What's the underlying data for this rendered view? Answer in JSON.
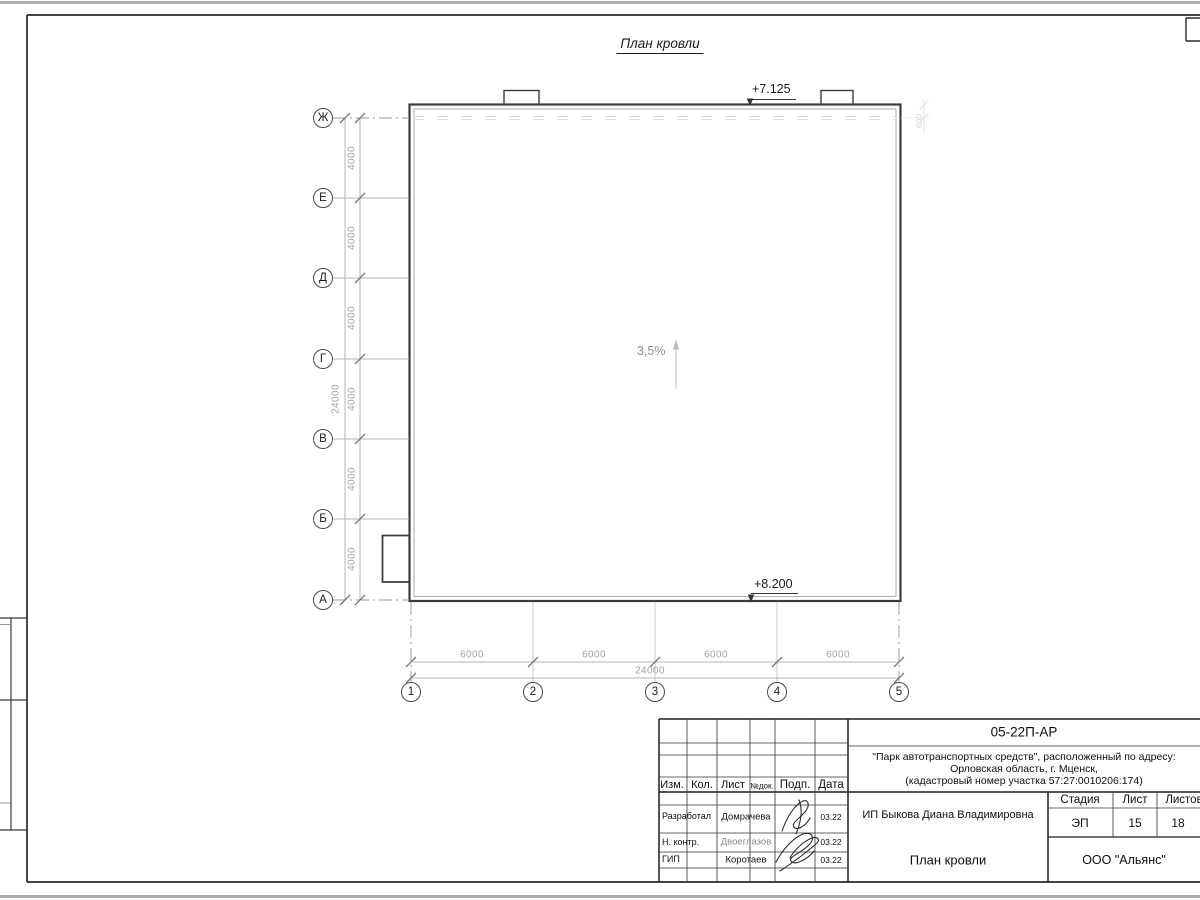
{
  "sheet": {
    "title": "План кровли",
    "slope": "3,5%",
    "elev_top": "+7.125",
    "elev_bottom": "+8.200",
    "small_dim": "600",
    "grid": {
      "rows": [
        "Ж",
        "Е",
        "Д",
        "Г",
        "В",
        "Б",
        "А"
      ],
      "cols": [
        "1",
        "2",
        "3",
        "4",
        "5"
      ],
      "row_dims": [
        "4000",
        "4000",
        "4000",
        "4000",
        "4000",
        "4000"
      ],
      "row_total": "24000",
      "col_dims": [
        "6000",
        "6000",
        "6000",
        "6000"
      ],
      "col_total": "24000"
    }
  },
  "title_block": {
    "doc_number": "05-22П-АР",
    "project_line1": "\"Парк автотранспортных средств\",  расположенный по адресу:",
    "project_line2": "Орловская область, г. Мценск,",
    "project_line3": "(кадастровый номер участка 57:27:0010206:174)",
    "client": "ИП Быкова Диана Владимировна",
    "drawing_title": "План кровли",
    "company": "ООО \"Альянс\"",
    "headers": {
      "izm": "Изм.",
      "kol": "Кол.",
      "list": "Лист",
      "ndok": "№док.",
      "podp": "Подп.",
      "data": "Дата",
      "stage": "Стадия",
      "sheet": "Лист",
      "sheets": "Листов"
    },
    "stage": "ЭП",
    "sheet_no": "15",
    "sheets_total": "18",
    "sign_rows": [
      {
        "role": "Разработал",
        "name": "Домрачева",
        "date": "03.22"
      },
      {
        "role": "Н. контр.",
        "name": "Двоеглазов",
        "date": "03.22"
      },
      {
        "role": "ГИП",
        "name": "Коротаев",
        "date": "03.22"
      }
    ]
  }
}
